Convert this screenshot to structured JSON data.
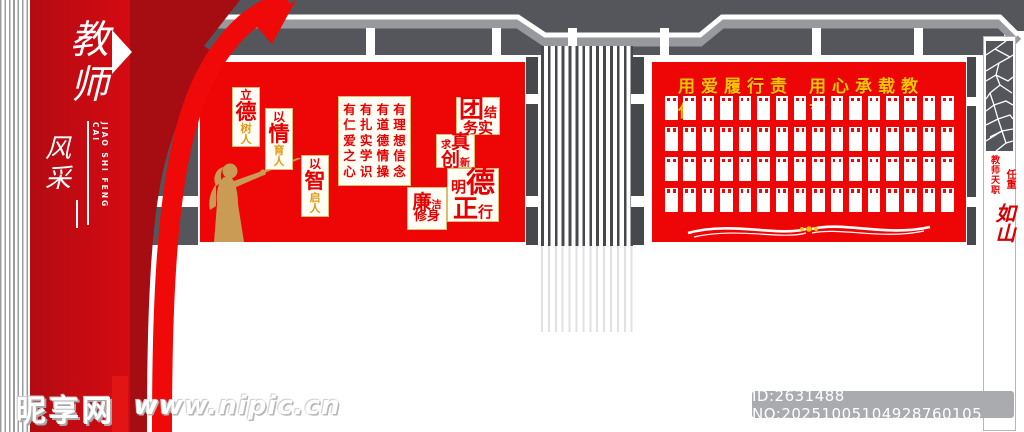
{
  "colors": {
    "panel_red": "#ee0505",
    "deep_red": "#a50d13",
    "column_red": "#c40711",
    "gold": "#fcc400",
    "plaque_border_gold": "#dcbc72",
    "text_red": "#e60000",
    "silhouette_tan": "#c99b55",
    "structure_gray": "#54565b",
    "light_gray": "#97999c"
  },
  "left_banner": {
    "title_chars": [
      "教",
      "师"
    ],
    "sub_chars": [
      "风",
      "采"
    ],
    "subtitle": "JIAO SHI FENG CAI"
  },
  "main_panel": {
    "plaques": [
      {
        "chars": [
          "立",
          "德",
          "树",
          "人"
        ]
      },
      {
        "chars": [
          "以",
          "情",
          "育",
          "人"
        ]
      },
      {
        "chars": [
          "以",
          "智",
          "启",
          "人"
        ]
      }
    ],
    "motto_columns": [
      [
        "有",
        "仁",
        "爱",
        "之",
        "心"
      ],
      [
        "有",
        "扎",
        "实",
        "学",
        "识"
      ],
      [
        "有",
        "道",
        "德",
        "情",
        "操"
      ],
      [
        "有",
        "理",
        "想",
        "信",
        "念"
      ]
    ],
    "value_plaques": [
      {
        "lines": [
          [
            "团",
            "结"
          ],
          [
            "务",
            "实"
          ]
        ]
      },
      {
        "lines": [
          [
            "求",
            "真"
          ],
          [
            "创",
            "新"
          ]
        ]
      },
      {
        "lines": [
          [
            "明",
            "德"
          ],
          [
            "正",
            "行"
          ]
        ]
      },
      {
        "lines": [
          [
            "廉",
            "洁"
          ],
          [
            "修",
            "身"
          ]
        ]
      }
    ]
  },
  "photo_panel": {
    "slogan_left": "用爱履行责任",
    "slogan_right": "用心承载教育",
    "grid": {
      "rows": 4,
      "cols": 16
    }
  },
  "right_column": {
    "line1": "教师天职",
    "line2": "任重",
    "calligraphy": "如山"
  },
  "watermark": {
    "site_name": "昵享网",
    "site_url": "www.nipic.cn",
    "id_text": "ID:2631488 NO:20251005104928760105"
  }
}
